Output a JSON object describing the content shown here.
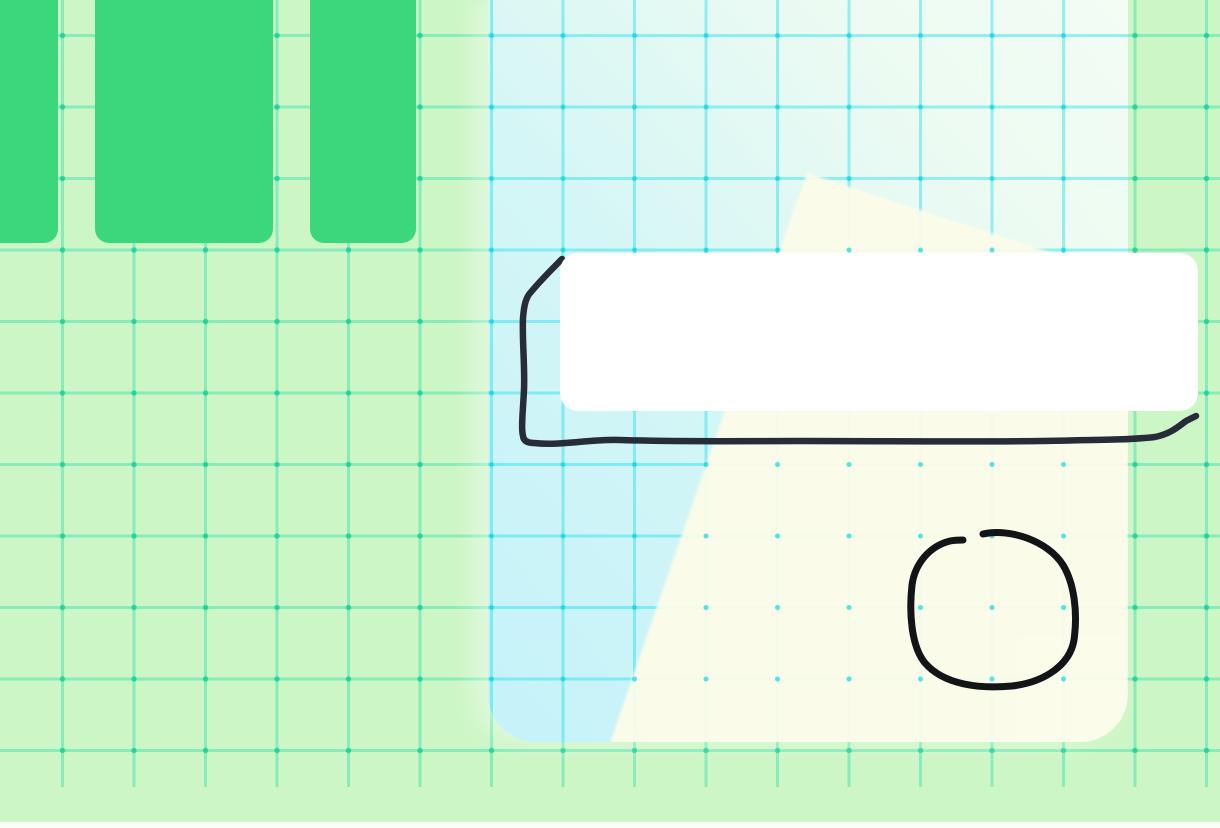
{
  "app": {
    "type": "whiteboard-canvas",
    "description": "infinite drawing canvas with grid background, green cards, gradient frame sheet, white note and freehand ink strokes"
  },
  "colors": {
    "bg_green": "#cdf6c6",
    "bg_grid_line": "rgba(34,218,166,0.40)",
    "bg_grid_dot": "rgba(10,206,146,0.72)",
    "card_green": "#3cd67d",
    "panel_cyan_deep": "#c5f2fa",
    "panel_cyan": "#d4f6f6",
    "panel_mint": "#edfbf2",
    "panel_grid_line": "rgba(24,221,235,0.42)",
    "panel_grid_dot": "rgba(0,213,229,0.66)",
    "cream": "#fdfce9",
    "note_white": "#ffffff",
    "ink_navy": "#272c38",
    "ink_black": "#121418",
    "edge_strip": "#fafdf8"
  },
  "grid": {
    "spacing_px": 71.5,
    "line_width_px": 3,
    "offset_x_px": 62.5,
    "offset_y_px": 35.5
  },
  "shapes": {
    "cards": [
      {
        "id": "green-card-1"
      },
      {
        "id": "green-card-2"
      },
      {
        "id": "green-card-3"
      }
    ],
    "frame": {
      "cream_points": "319,173 640,278 640,760 116,760"
    },
    "note": {
      "id": "note-box"
    },
    "strokes": {
      "rectangle_d": "M562 259 C552 269 540 281 531 292 C526 297 524 305 523 318 C522 340 525 365 524 390 C523 410 521 428 523 436 Q524 443 534 443 C560 446 590 439 620 440 C680 442 740 441 800 441 C880 441 960 442 1040 441 C1090 440 1130 440 1155 437 C1170 434 1178 427 1186 421 L1196 416",
      "circle_d": "M983 534 C1010 528 1048 541 1063 565 C1074 583 1078 612 1074 640 C1070 664 1046 682 1012 686 C980 689 944 685 925 663 C911 646 909 612 912 585 C915 563 930 546 950 541 C955 540 959 540 963 540"
    }
  }
}
